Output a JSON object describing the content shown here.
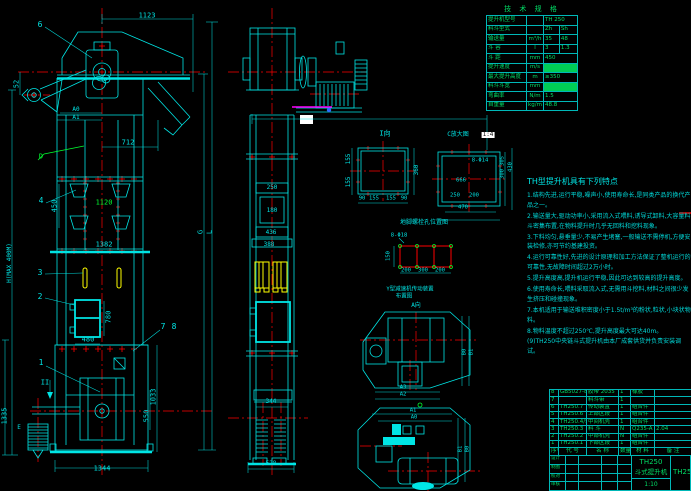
{
  "colors": {
    "line": "#00e5e5",
    "centerline": "#ff0000",
    "aux_green": "#00ff30",
    "bucket_yellow": "#ffff00",
    "accent_magenta": "#ff00ff",
    "table_green": "#00dd66",
    "background": "#000000"
  },
  "front_view": {
    "dims": {
      "top": "1123",
      "chute": "712",
      "left_small": "52",
      "a0": "A0",
      "a1": "A1",
      "pitch": "450",
      "mid": "1120",
      "flange": "1382",
      "door_h": "780",
      "door_w": "480",
      "base": "1344",
      "boot_h": "1033",
      "boot_inner": "550",
      "left_boot": "1335",
      "height": "H(MAX 400M)",
      "g": "G",
      "l": "L"
    },
    "labels": {
      "d": "D",
      "section": "II",
      "e": "E"
    },
    "balloons": {
      "b1": "1",
      "b2": "2",
      "b3": "3",
      "b4": "4",
      "b6": "6",
      "b7": "7",
      "b8": "8"
    }
  },
  "side_view": {
    "dims": {
      "d1": "250",
      "d2": "180",
      "d3": "436",
      "d4": "388",
      "mid": "344",
      "base": "528"
    }
  },
  "detail_i": {
    "title": "I向",
    "left1": "155",
    "left2": "155",
    "right": "360",
    "b1": "90",
    "b2": "155",
    "b3": "155",
    "b4": "90"
  },
  "detail_c": {
    "title": "C放大图",
    "scale": "1:4",
    "hole": "8-Φ14",
    "inner": "666",
    "b1": "250",
    "b2": "200",
    "b3": "470",
    "r1": "305",
    "r2": "300",
    "r3": "430"
  },
  "detail_anchor": {
    "title": "地脚螺栓孔位置图",
    "hole": "8-Φ18",
    "h": "150",
    "b1": "200",
    "b2": "300",
    "b3": "200"
  },
  "layout_top": {
    "title": "Y型减速机传动装置",
    "subtitle": "布置图",
    "view": "A向",
    "a2": "A2",
    "a3": "A3",
    "b0": "B0",
    "b1": "B1"
  },
  "layout_bottom": {
    "a1": "A1",
    "a0": "A0",
    "b0": "B0",
    "b1": "B1"
  },
  "spec_table": {
    "title": "技 术 规 格",
    "rows": [
      {
        "label": "提升机型号",
        "unit": "",
        "v1": "TH 250",
        "span": true
      },
      {
        "label": "料斗型式",
        "unit": "",
        "v1": "Zh",
        "v2": "Sh"
      },
      {
        "label": "输送量",
        "unit": "m³/h",
        "v1": "35",
        "v2": "48"
      },
      {
        "label": "斗 容",
        "unit": "l",
        "v1": "3",
        "v2": "1.3"
      },
      {
        "label": "斗 距",
        "unit": "mm",
        "v1": "450",
        "span": true
      },
      {
        "label": "提升速度",
        "unit": "m/s",
        "v1": "1.4",
        "span": true,
        "hl": true
      },
      {
        "label": "最大提升高度",
        "unit": "m",
        "v1": "≥350",
        "span": true
      },
      {
        "label": "料斗斗宽",
        "unit": "mm",
        "v1": "250",
        "span": true,
        "hl": true
      },
      {
        "label": "弯曲率",
        "unit": "N/m",
        "v1": "1.5",
        "span": true
      },
      {
        "label": "自重量",
        "unit": "kg/m",
        "v1": "48.8",
        "span": true
      }
    ]
  },
  "notes": {
    "title": "TH型提升机具有下列特点",
    "lines": [
      "1.结构先进,运行平稳,噪声小,使用寿命长,是同类产品的换代产品之一。",
      "2.输送量大,驱动功率小,采用流入式喂料,诱导式卸料,大容量料斗密集布置,在物料提升时几乎无回料和挖料现象。",
      "3.下料均匀,悬垂量少,不易产生堵塞,一般输送不需停机,方便安装检修,亦可节约基建投资。",
      "4.运行可靠性好,先进的设计原理和加工方法保证了整机运行的可靠性,无故障时间超过2万小时。",
      "5.提升高度高,提升机运行平稳,因此可达到较高的提升高度。",
      "6.使用寿命长,喂料采取流入式,无需用斗挖料,材料之间很少发生挤压和碰撞现象。",
      "7.本机适用于输送堆积密度小于1.5t/m³的粉状,粒状,小块状物料。",
      "8.物料温度不超过250℃,提升高度最大可达40m。",
      "(9)TH250中央链斗式提升机由本厂成套供货并负责安装调试。"
    ]
  },
  "bom": {
    "headers": [
      "序号",
      "代 号",
      "名 称",
      "数量",
      "材 料",
      "备 注"
    ],
    "rows": [
      [
        "8",
        "GB5027-86",
        "胶带 2035",
        "1",
        "橡胶",
        ""
      ],
      [
        "7",
        "",
        "料斗带",
        "1",
        "",
        ""
      ],
      [
        "6",
        "TH250.7",
        "传动装置",
        "1",
        "组合件",
        ""
      ],
      [
        "5",
        "TH250.6",
        "上部区段",
        "1",
        "组合件",
        ""
      ],
      [
        "4",
        "TH250.4/5",
        "中间机壳",
        "1",
        "组合件",
        ""
      ],
      [
        "3",
        "TH250.3",
        "料 斗",
        "N",
        "Q235-A",
        "2.04"
      ],
      [
        "2",
        "TH250.2",
        "中部机壳",
        "N",
        "组合件",
        ""
      ],
      [
        "1",
        "TH250.1",
        "下部区段",
        "1",
        "组合件",
        ""
      ]
    ]
  },
  "title_block": {
    "sign_labels": [
      "设计",
      "制图",
      "校对",
      "审核"
    ],
    "model": "TH250",
    "name": "斗式提升机",
    "scale": "1:10",
    "right_text": "TH250"
  }
}
